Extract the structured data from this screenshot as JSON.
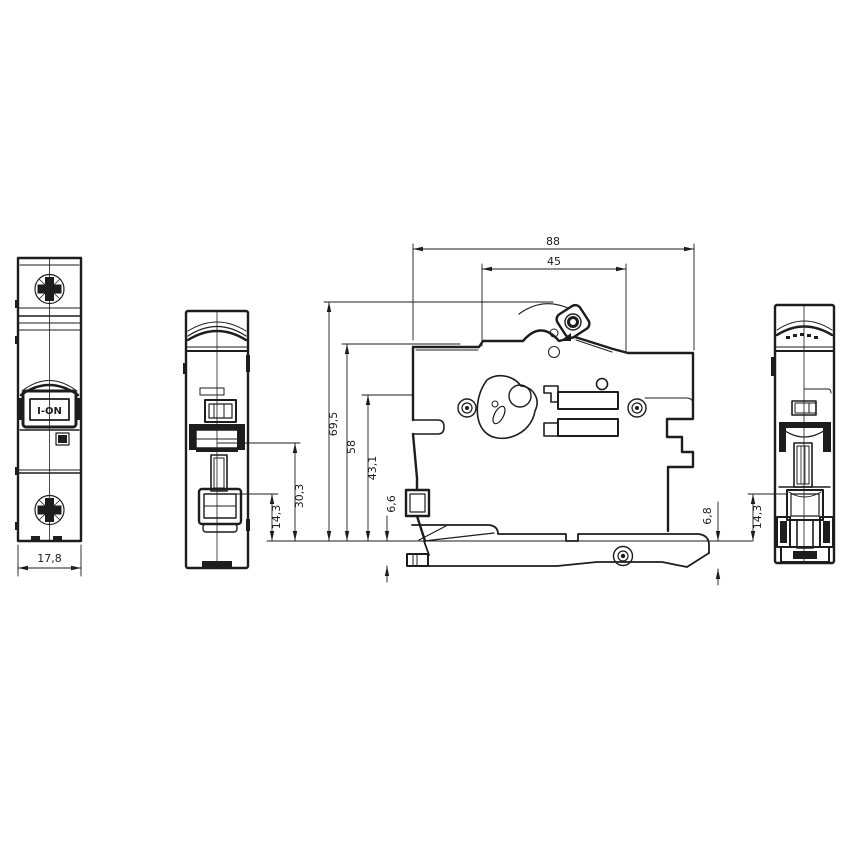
{
  "labels": {
    "toggle": "I-ON"
  },
  "dims": {
    "front_width": "17,8",
    "overall_depth": "88",
    "handle_zone_depth": "45",
    "height_overall": "69,5",
    "height_body_top": "58",
    "height_rail_hook": "43,1",
    "height_mid": "30,3",
    "height_terminal_left": "14,3",
    "below_rail_left": "6,6",
    "below_rail_right": "6,8",
    "height_terminal_right": "14,3"
  },
  "colors": {
    "ink": "#1d1d1d",
    "background": "#ffffff"
  }
}
